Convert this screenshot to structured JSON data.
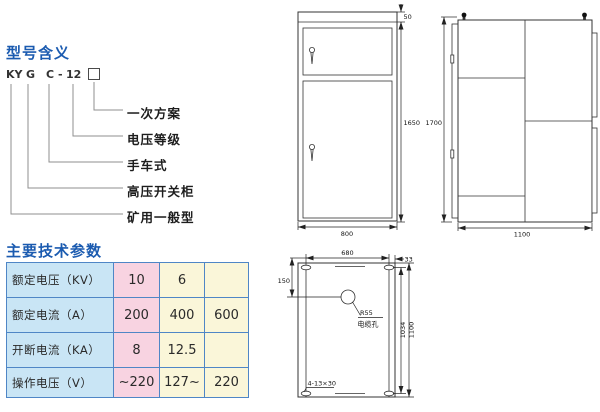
{
  "colors": {
    "heading_blue": "#1b5bb0",
    "table_border": "#4f86c6",
    "table_label_bg": "#c9e5f5",
    "table_pink_bg": "#f8d3e1",
    "table_cream_bg": "#faf6d9",
    "drawing_line": "#333333"
  },
  "model_meaning": {
    "title": "型号含义",
    "code": {
      "part1": "KY",
      "part2": "G",
      "part3": "C",
      "dash": "-",
      "part4": "12"
    },
    "labels": [
      "一次方案",
      "电压等级",
      "手车式",
      "高压开关柜",
      "矿用一般型"
    ]
  },
  "tech_params": {
    "title": "主要技术参数",
    "rows": [
      {
        "label": "额定电压（KV）",
        "v1": "10",
        "v2": "6",
        "v3": ""
      },
      {
        "label": "额定电流（A）",
        "v1": "200",
        "v2": "400",
        "v3": "600"
      },
      {
        "label": "开断电流（KA）",
        "v1": "8",
        "v2": "12.5",
        "v3": ""
      },
      {
        "label": "操作电压（V）",
        "v1": "~220",
        "v2": "127~",
        "v3": "220"
      }
    ]
  },
  "drawings": {
    "front_view": {
      "top_frame_mm": "50",
      "height_mm": "1650",
      "width_mm": "800"
    },
    "side_view": {
      "height_mm": "1700",
      "width_mm": "1100"
    },
    "plan_view": {
      "hole_span_mm": "680",
      "edge_offset_mm": "33",
      "cable_hole_offset_mm": "150",
      "cable_hole_radius": "R55",
      "cable_hole_label": "电缆孔",
      "mounting_slots": "4-13×30",
      "hole_pitch_mm": "1034",
      "depth_mm": "1100"
    }
  }
}
